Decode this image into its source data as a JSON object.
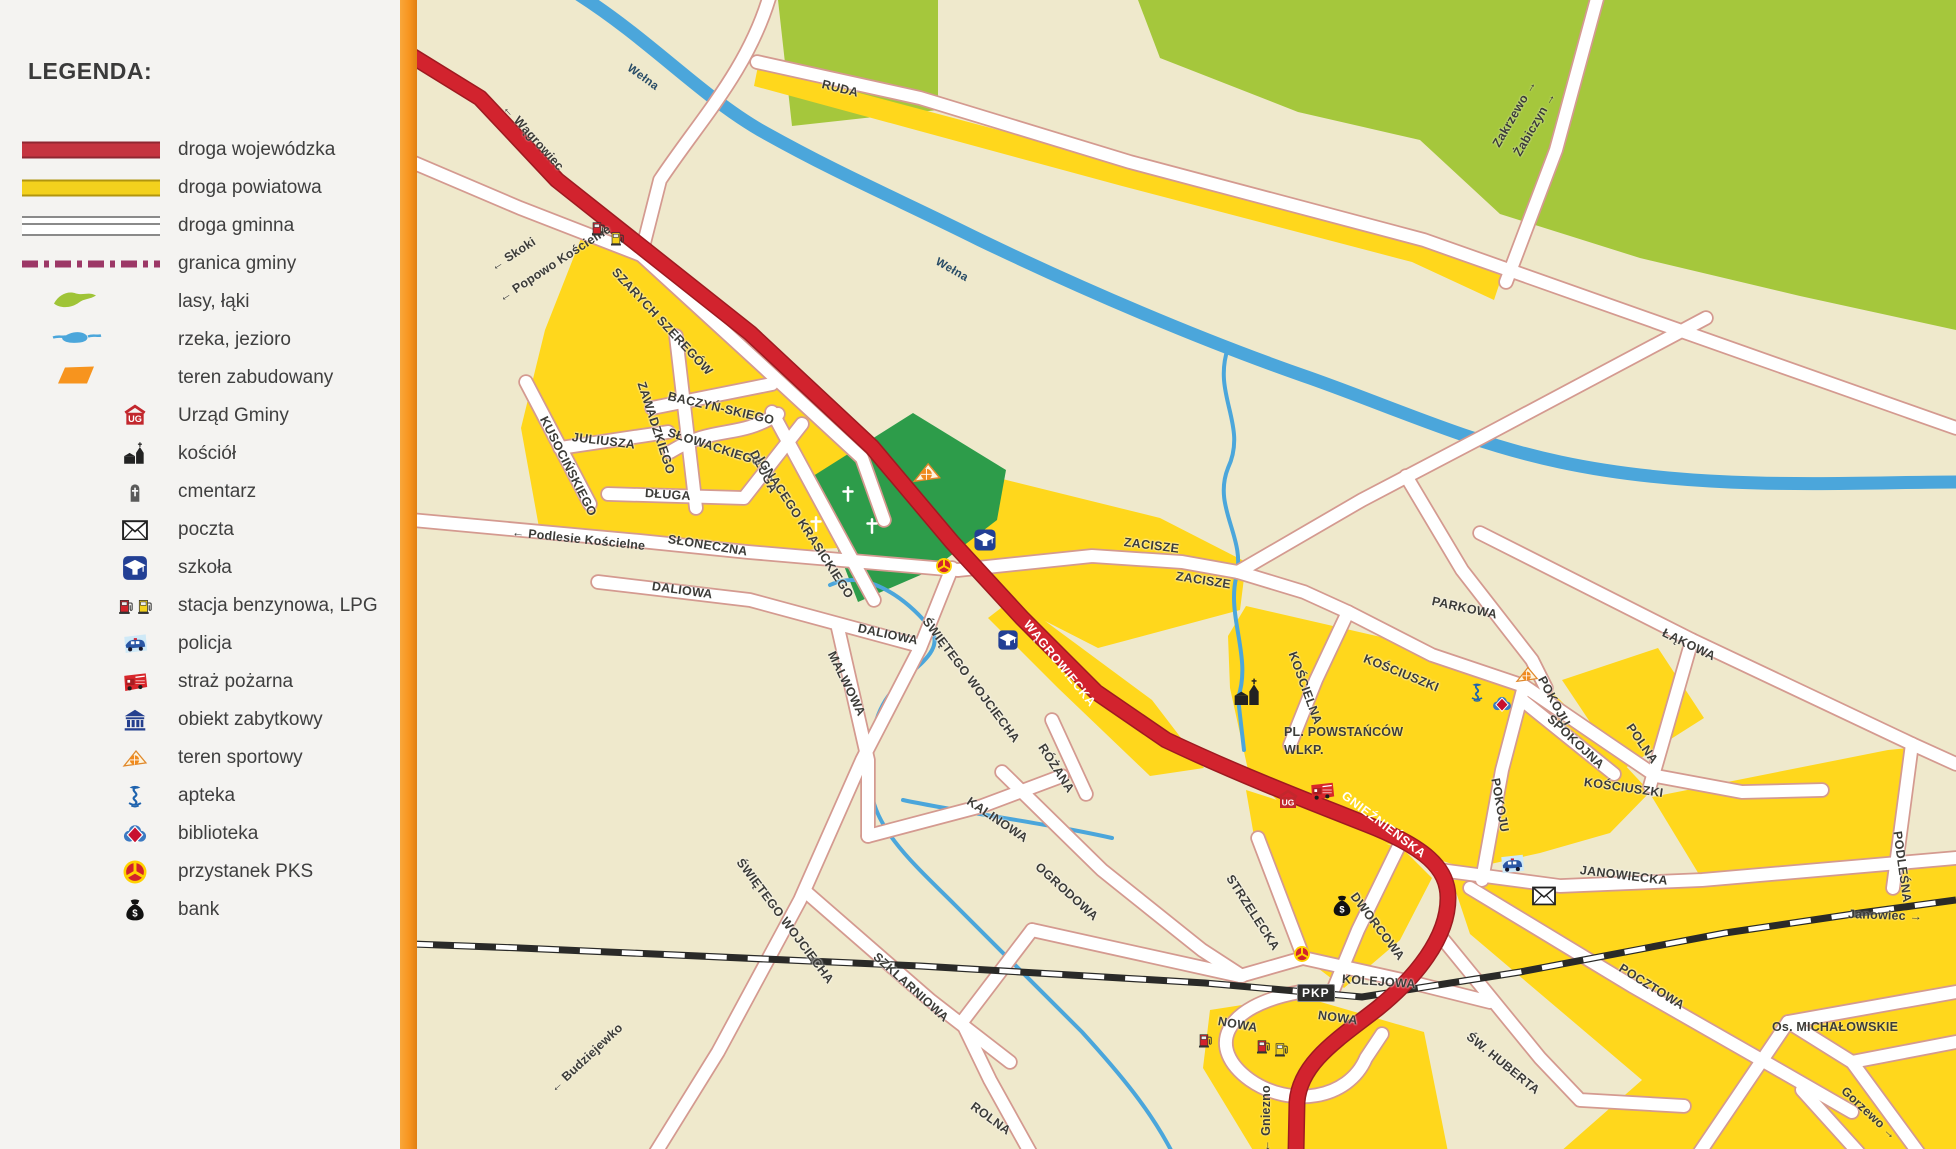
{
  "legend": {
    "title": "LEGENDA:",
    "items": [
      {
        "icon": "swatch-road-red",
        "label": "droga wojewódzka"
      },
      {
        "icon": "swatch-road-yellow",
        "label": "droga powiatowa"
      },
      {
        "icon": "swatch-road-white",
        "label": "droga gminna"
      },
      {
        "icon": "swatch-border",
        "label": "granica gminy"
      },
      {
        "icon": "swatch-forest",
        "label": "lasy, łąki"
      },
      {
        "icon": "swatch-water",
        "label": "rzeka, jezioro"
      },
      {
        "icon": "swatch-builtup",
        "label": "teren zabudowany"
      },
      {
        "icon": "ug",
        "label": "Urząd Gminy"
      },
      {
        "icon": "church",
        "label": "kościół"
      },
      {
        "icon": "cemetery",
        "label": "cmentarz"
      },
      {
        "icon": "post",
        "label": "poczta"
      },
      {
        "icon": "school",
        "label": "szkoła"
      },
      {
        "icon": "fuel-pair",
        "label": "stacja benzynowa, LPG"
      },
      {
        "icon": "police",
        "label": "policja"
      },
      {
        "icon": "fire",
        "label": "straż pożarna"
      },
      {
        "icon": "monument",
        "label": "obiekt zabytkowy"
      },
      {
        "icon": "sport",
        "label": "teren sportowy"
      },
      {
        "icon": "pharmacy",
        "label": "apteka"
      },
      {
        "icon": "library",
        "label": "biblioteka"
      },
      {
        "icon": "pks",
        "label": "przystanek PKS"
      },
      {
        "icon": "bank",
        "label": "bank"
      }
    ]
  },
  "map": {
    "colors": {
      "cream": "#EFE9CC",
      "builtup": "#FFD71C",
      "forest": "#A5C73C",
      "cemetery_green": "#2D9C4A",
      "water": "#4BA6DB",
      "road_red": "#D2232E",
      "road_white": "#FFFFFF",
      "border_orange": "#F7941E",
      "railway": "#2A2A28"
    },
    "badges": [
      {
        "text": "PKP",
        "x": 1297,
        "y": 984
      }
    ],
    "labels": [
      {
        "text": "← Wągrowiec",
        "x": 505,
        "y": 100,
        "r": 48,
        "cls": "dir"
      },
      {
        "text": "Wełna",
        "x": 628,
        "y": 62,
        "r": 36,
        "cls": "riv"
      },
      {
        "text": "Wełna",
        "x": 936,
        "y": 256,
        "r": 30,
        "cls": "riv"
      },
      {
        "text": "RUDA",
        "x": 822,
        "y": 78,
        "r": 14,
        "cls": "st"
      },
      {
        "text": "Zakrzewo →",
        "x": 1496,
        "y": 140,
        "r": -60,
        "cls": "dir"
      },
      {
        "text": "Żabiczyn →",
        "x": 1517,
        "y": 149,
        "r": -60,
        "cls": "dir"
      },
      {
        "text": "← Skoki",
        "x": 492,
        "y": 262,
        "r": -33,
        "cls": "dir"
      },
      {
        "text": "← Popowo Kościelne",
        "x": 500,
        "y": 293,
        "r": -33,
        "cls": "dir"
      },
      {
        "text": "SZARYCH SZEREGÓW",
        "x": 614,
        "y": 264,
        "r": 47,
        "cls": "st"
      },
      {
        "text": "ZAWADZKIEGO",
        "x": 641,
        "y": 376,
        "r": 72,
        "cls": "st"
      },
      {
        "text": "BACZYŃ-SKIEGO",
        "x": 668,
        "y": 390,
        "r": 13,
        "cls": "st"
      },
      {
        "text": "SŁOWACKIEGO",
        "x": 668,
        "y": 426,
        "r": 18,
        "cls": "st"
      },
      {
        "text": "JULIUSZA",
        "x": 572,
        "y": 431,
        "r": 7,
        "cls": "st"
      },
      {
        "text": "KUSOCIŃSKIEGO",
        "x": 543,
        "y": 411,
        "r": 63,
        "cls": "st"
      },
      {
        "text": "DŁUGA",
        "x": 753,
        "y": 445,
        "r": 63,
        "cls": "st"
      },
      {
        "text": "DŁUGA",
        "x": 645,
        "y": 487,
        "r": 4,
        "cls": "st"
      },
      {
        "text": "← Podlesie Kościelne",
        "x": 512,
        "y": 526,
        "r": 6,
        "cls": "dir"
      },
      {
        "text": "SŁONECZNA",
        "x": 668,
        "y": 533,
        "r": 9,
        "cls": "st"
      },
      {
        "text": "IGNACEGO KRASICKIEGO",
        "x": 760,
        "y": 452,
        "r": 57,
        "cls": "st"
      },
      {
        "text": "DALIOWA",
        "x": 652,
        "y": 580,
        "r": 8,
        "cls": "st"
      },
      {
        "text": "DALIOWA",
        "x": 858,
        "y": 622,
        "r": 12,
        "cls": "st"
      },
      {
        "text": "MALWOWA",
        "x": 831,
        "y": 646,
        "r": 64,
        "cls": "st"
      },
      {
        "text": "ŚWIĘTEGO WOJCIECHA",
        "x": 925,
        "y": 613,
        "r": 53,
        "cls": "st"
      },
      {
        "text": "WĄGROWIECKA",
        "x": 1026,
        "y": 616,
        "r": 51,
        "cls": "w"
      },
      {
        "text": "RÓŻANA",
        "x": 1041,
        "y": 739,
        "r": 57,
        "cls": "st"
      },
      {
        "text": "KALINOWA",
        "x": 968,
        "y": 794,
        "r": 34,
        "cls": "st"
      },
      {
        "text": "ZACISZE",
        "x": 1124,
        "y": 536,
        "r": 7,
        "cls": "st"
      },
      {
        "text": "ZACISZE",
        "x": 1176,
        "y": 570,
        "r": 9,
        "cls": "st"
      },
      {
        "text": "PARKOWA",
        "x": 1432,
        "y": 595,
        "r": 12,
        "cls": "st"
      },
      {
        "text": "KOŚCIELNA",
        "x": 1292,
        "y": 646,
        "r": 70,
        "cls": "st"
      },
      {
        "text": "KOŚCIUSZKI",
        "x": 1364,
        "y": 652,
        "r": 22,
        "cls": "st"
      },
      {
        "text": "POKOJU",
        "x": 1541,
        "y": 671,
        "r": 62,
        "cls": "st"
      },
      {
        "text": "SPOKOJNA",
        "x": 1549,
        "y": 711,
        "r": 43,
        "cls": "st"
      },
      {
        "text": "POLNA",
        "x": 1629,
        "y": 719,
        "r": 55,
        "cls": "st"
      },
      {
        "text": "ŁĄKOWA",
        "x": 1663,
        "y": 626,
        "r": 26,
        "cls": "st"
      },
      {
        "text": "PL. POWSTAŃCÓW",
        "x": 1284,
        "y": 726,
        "r": 0,
        "cls": "pl"
      },
      {
        "text": "WLKP.",
        "x": 1284,
        "y": 744,
        "r": 0,
        "cls": "pl"
      },
      {
        "text": "GNIEŹNIEŃSKA",
        "x": 1343,
        "y": 788,
        "r": 37,
        "cls": "w"
      },
      {
        "text": "KOŚCIUSZKI",
        "x": 1584,
        "y": 776,
        "r": 8,
        "cls": "st"
      },
      {
        "text": "POKOJU",
        "x": 1495,
        "y": 772,
        "r": 80,
        "cls": "st"
      },
      {
        "text": "JANOWIECKA",
        "x": 1580,
        "y": 864,
        "r": 7,
        "cls": "st"
      },
      {
        "text": "STRZELECKA",
        "x": 1229,
        "y": 870,
        "r": 57,
        "cls": "st"
      },
      {
        "text": "DWORCOWA",
        "x": 1353,
        "y": 888,
        "r": 53,
        "cls": "st"
      },
      {
        "text": "OGRODOWA",
        "x": 1037,
        "y": 859,
        "r": 42,
        "cls": "st"
      },
      {
        "text": "ŚWIĘTEGO WOJCIECHA",
        "x": 739,
        "y": 854,
        "r": 53,
        "cls": "st"
      },
      {
        "text": "SZKLARNIOWA",
        "x": 875,
        "y": 949,
        "r": 42,
        "cls": "st"
      },
      {
        "text": "← Budziejewko",
        "x": 552,
        "y": 1084,
        "r": -43,
        "cls": "dir"
      },
      {
        "text": "ROLNA",
        "x": 972,
        "y": 1099,
        "r": 36,
        "cls": "st"
      },
      {
        "text": "NOWA",
        "x": 1218,
        "y": 1015,
        "r": 10,
        "cls": "st"
      },
      {
        "text": "NOWA",
        "x": 1318,
        "y": 1009,
        "r": 8,
        "cls": "st"
      },
      {
        "text": "KOLEJOWA",
        "x": 1342,
        "y": 973,
        "r": 4,
        "cls": "st"
      },
      {
        "text": "← Gniezno",
        "x": 1266,
        "y": 1146,
        "r": -90,
        "cls": "dir"
      },
      {
        "text": "ŚW. HUBERTA",
        "x": 1468,
        "y": 1029,
        "r": 39,
        "cls": "st"
      },
      {
        "text": "POCZTOWA",
        "x": 1620,
        "y": 961,
        "r": 32,
        "cls": "st"
      },
      {
        "text": "Os. MICHAŁOWSKIE",
        "x": 1772,
        "y": 1021,
        "r": 0,
        "cls": "pl"
      },
      {
        "text": "Gorzewo →",
        "x": 1843,
        "y": 1083,
        "r": 43,
        "cls": "dir"
      },
      {
        "text": "Janowiec →",
        "x": 1848,
        "y": 908,
        "r": 2,
        "cls": "dir"
      },
      {
        "text": "PODLEŚNA",
        "x": 1897,
        "y": 825,
        "r": 82,
        "cls": "st"
      }
    ],
    "icons": [
      {
        "type": "fuel-red",
        "x": 598,
        "y": 228,
        "s": 17
      },
      {
        "type": "fuel-yellow",
        "x": 617,
        "y": 238,
        "s": 17
      },
      {
        "type": "sport",
        "x": 927,
        "y": 472,
        "s": 30
      },
      {
        "type": "cross",
        "x": 848,
        "y": 494,
        "s": 20
      },
      {
        "type": "cross",
        "x": 816,
        "y": 524,
        "s": 20
      },
      {
        "type": "cross",
        "x": 872,
        "y": 526,
        "s": 20
      },
      {
        "type": "school",
        "x": 985,
        "y": 540,
        "s": 23
      },
      {
        "type": "school",
        "x": 1008,
        "y": 640,
        "s": 21
      },
      {
        "type": "pks",
        "x": 944,
        "y": 566,
        "s": 18
      },
      {
        "type": "pks",
        "x": 1302,
        "y": 954,
        "s": 18
      },
      {
        "type": "ug",
        "x": 1288,
        "y": 800,
        "s": 24
      },
      {
        "type": "fire",
        "x": 1322,
        "y": 791,
        "s": 26
      },
      {
        "type": "church",
        "x": 1248,
        "y": 693,
        "s": 32
      },
      {
        "type": "pharmacy",
        "x": 1477,
        "y": 692,
        "s": 22
      },
      {
        "type": "library",
        "x": 1502,
        "y": 704,
        "s": 21
      },
      {
        "type": "sport",
        "x": 1527,
        "y": 674,
        "s": 24
      },
      {
        "type": "police",
        "x": 1512,
        "y": 864,
        "s": 26
      },
      {
        "type": "post",
        "x": 1544,
        "y": 896,
        "s": 24
      },
      {
        "type": "bank",
        "x": 1342,
        "y": 906,
        "s": 25
      },
      {
        "type": "fuel-red",
        "x": 1205,
        "y": 1040,
        "s": 17
      },
      {
        "type": "fuel-red",
        "x": 1263,
        "y": 1046,
        "s": 17
      },
      {
        "type": "fuel-yellow",
        "x": 1281,
        "y": 1049,
        "s": 17
      }
    ]
  }
}
